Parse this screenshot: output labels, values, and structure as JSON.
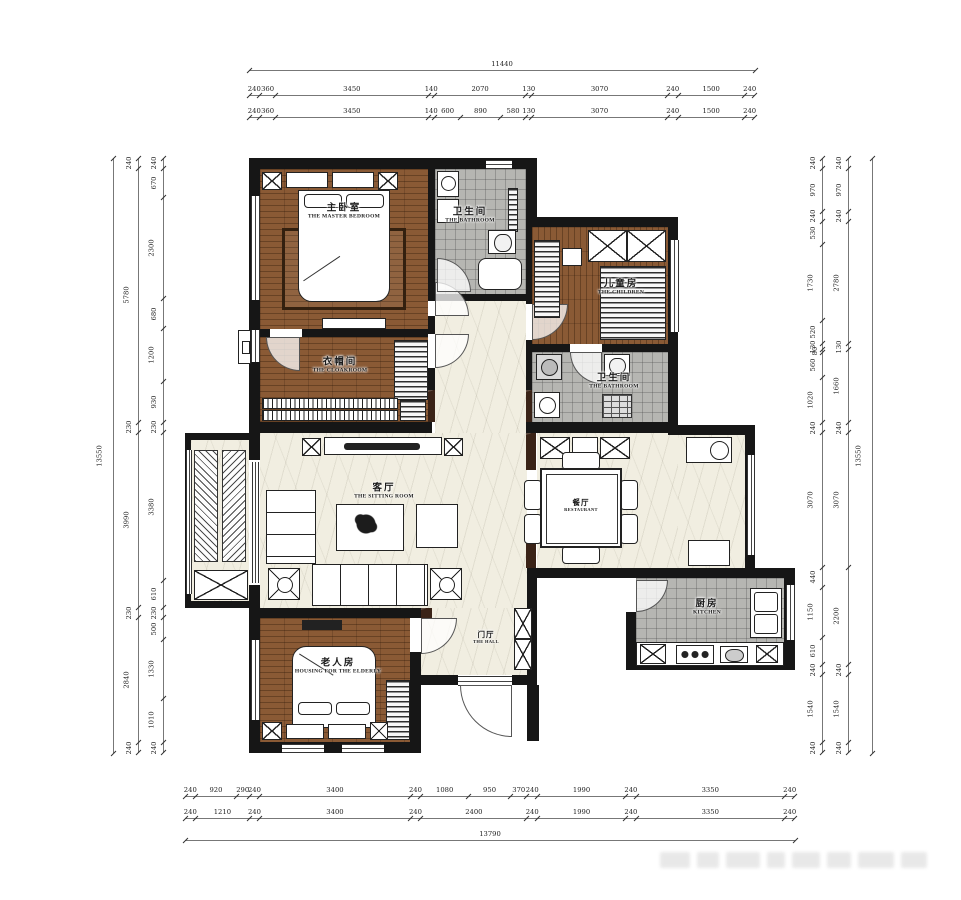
{
  "title": "residential floor plan",
  "rooms": {
    "master": {
      "zh": "主卧室",
      "en": "THE MASTER BEDROOM"
    },
    "bath1": {
      "zh": "卫生间",
      "en": "THE BATHROOM"
    },
    "children": {
      "zh": "儿童房",
      "en": "THE CHILDREN"
    },
    "cloakroom": {
      "zh": "衣帽间",
      "en": "THE CLOAKROOM"
    },
    "bath2": {
      "zh": "卫生间",
      "en": "THE BATHROOM"
    },
    "sitting": {
      "zh": "客厅",
      "en": "THE SITTING ROOM"
    },
    "dining": {
      "zh": "餐厅",
      "en": "RESTAURANT"
    },
    "kitchen": {
      "zh": "厨房",
      "en": "KITCHEN"
    },
    "elderly": {
      "zh": "老人房",
      "en": "HOUSING FOR THE ELDERLY"
    },
    "hall": {
      "zh": "门厅",
      "en": "THE HALL"
    }
  },
  "dimensions": {
    "top": {
      "total": [
        11440
      ],
      "row_a": [
        240,
        360,
        3450,
        140,
        2070,
        130,
        3070,
        240,
        1500,
        240
      ],
      "row_b": [
        240,
        360,
        3450,
        140,
        600,
        890,
        580,
        130,
        3070,
        240,
        1500,
        240
      ]
    },
    "bottom": {
      "row_a": [
        240,
        920,
        290,
        240,
        3400,
        240,
        1080,
        950,
        370,
        240,
        1990,
        240,
        3350,
        240
      ],
      "row_b": [
        240,
        1210,
        240,
        3400,
        240,
        2400,
        240,
        1990,
        240,
        3350,
        240
      ],
      "total": [
        13790
      ]
    },
    "left": {
      "total": [
        13550
      ],
      "mid": [
        240,
        5780,
        230,
        3990,
        230,
        2840,
        240
      ],
      "inner": [
        240,
        670,
        2300,
        680,
        1200,
        930,
        230,
        3380,
        610,
        230,
        500,
        1330,
        1010,
        240
      ]
    },
    "right": {
      "inner": [
        240,
        970,
        240,
        530,
        1730,
        520,
        130,
        80,
        560,
        1020,
        240,
        3070,
        440,
        1150,
        610,
        240,
        1540,
        240
      ],
      "mid": [
        240,
        970,
        240,
        2780,
        130,
        1660,
        240,
        3070,
        2200,
        240,
        1540,
        240
      ],
      "total": [
        13550
      ]
    }
  },
  "colors": {
    "wood": "#8a5a35",
    "tile": "#b6b6b2",
    "marble": "#f1eee1",
    "wall": "#161616",
    "dark_marble": "#3a2317",
    "dim_line": "#777"
  }
}
